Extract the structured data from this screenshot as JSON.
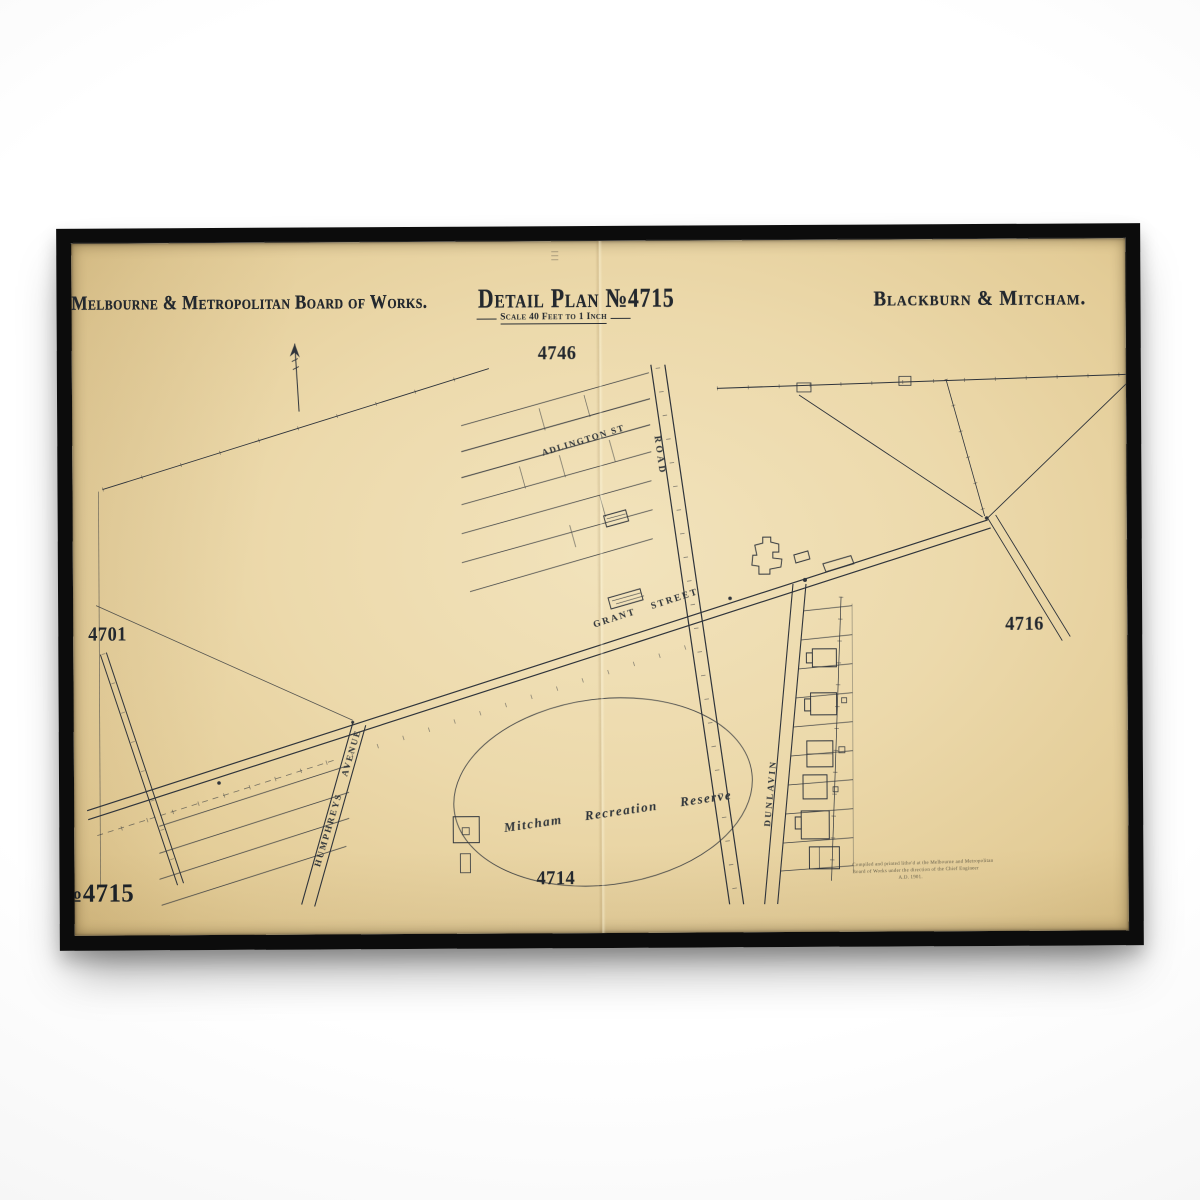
{
  "poster": {
    "publisher_title": "Melbourne & Metropolitan Board of Works.",
    "plan_title": "Detail Plan №4715",
    "plan_scale": "Scale 40 Feet to 1 Inch",
    "locality_title": "Blackburn & Mitcham.",
    "adjoining": {
      "top": "4746",
      "left": "4701",
      "right": "4716",
      "bottom": "4714"
    },
    "plan_number_corner": "№4715",
    "streets": {
      "adlington": "ADLINGTON ST",
      "road": "ROAD",
      "grant": "GRANT STREET",
      "humphreys": "HUMPHREYS AVENUE",
      "dunlavin": "DUNLAVIN"
    },
    "places": {
      "reserve": "Mitcham Recreation Reserve"
    },
    "imprint_lines": [
      "Compiled and printed litho'd at the Melbourne and Metropolitan",
      "Board of Works under the direction of the Chief Engineer",
      "A.D. 1901."
    ]
  },
  "colors": {
    "wall": "#f4f4f4",
    "frame": "#0c0c0c",
    "paper": "#ecd9ab",
    "ink": "#2f343b"
  }
}
